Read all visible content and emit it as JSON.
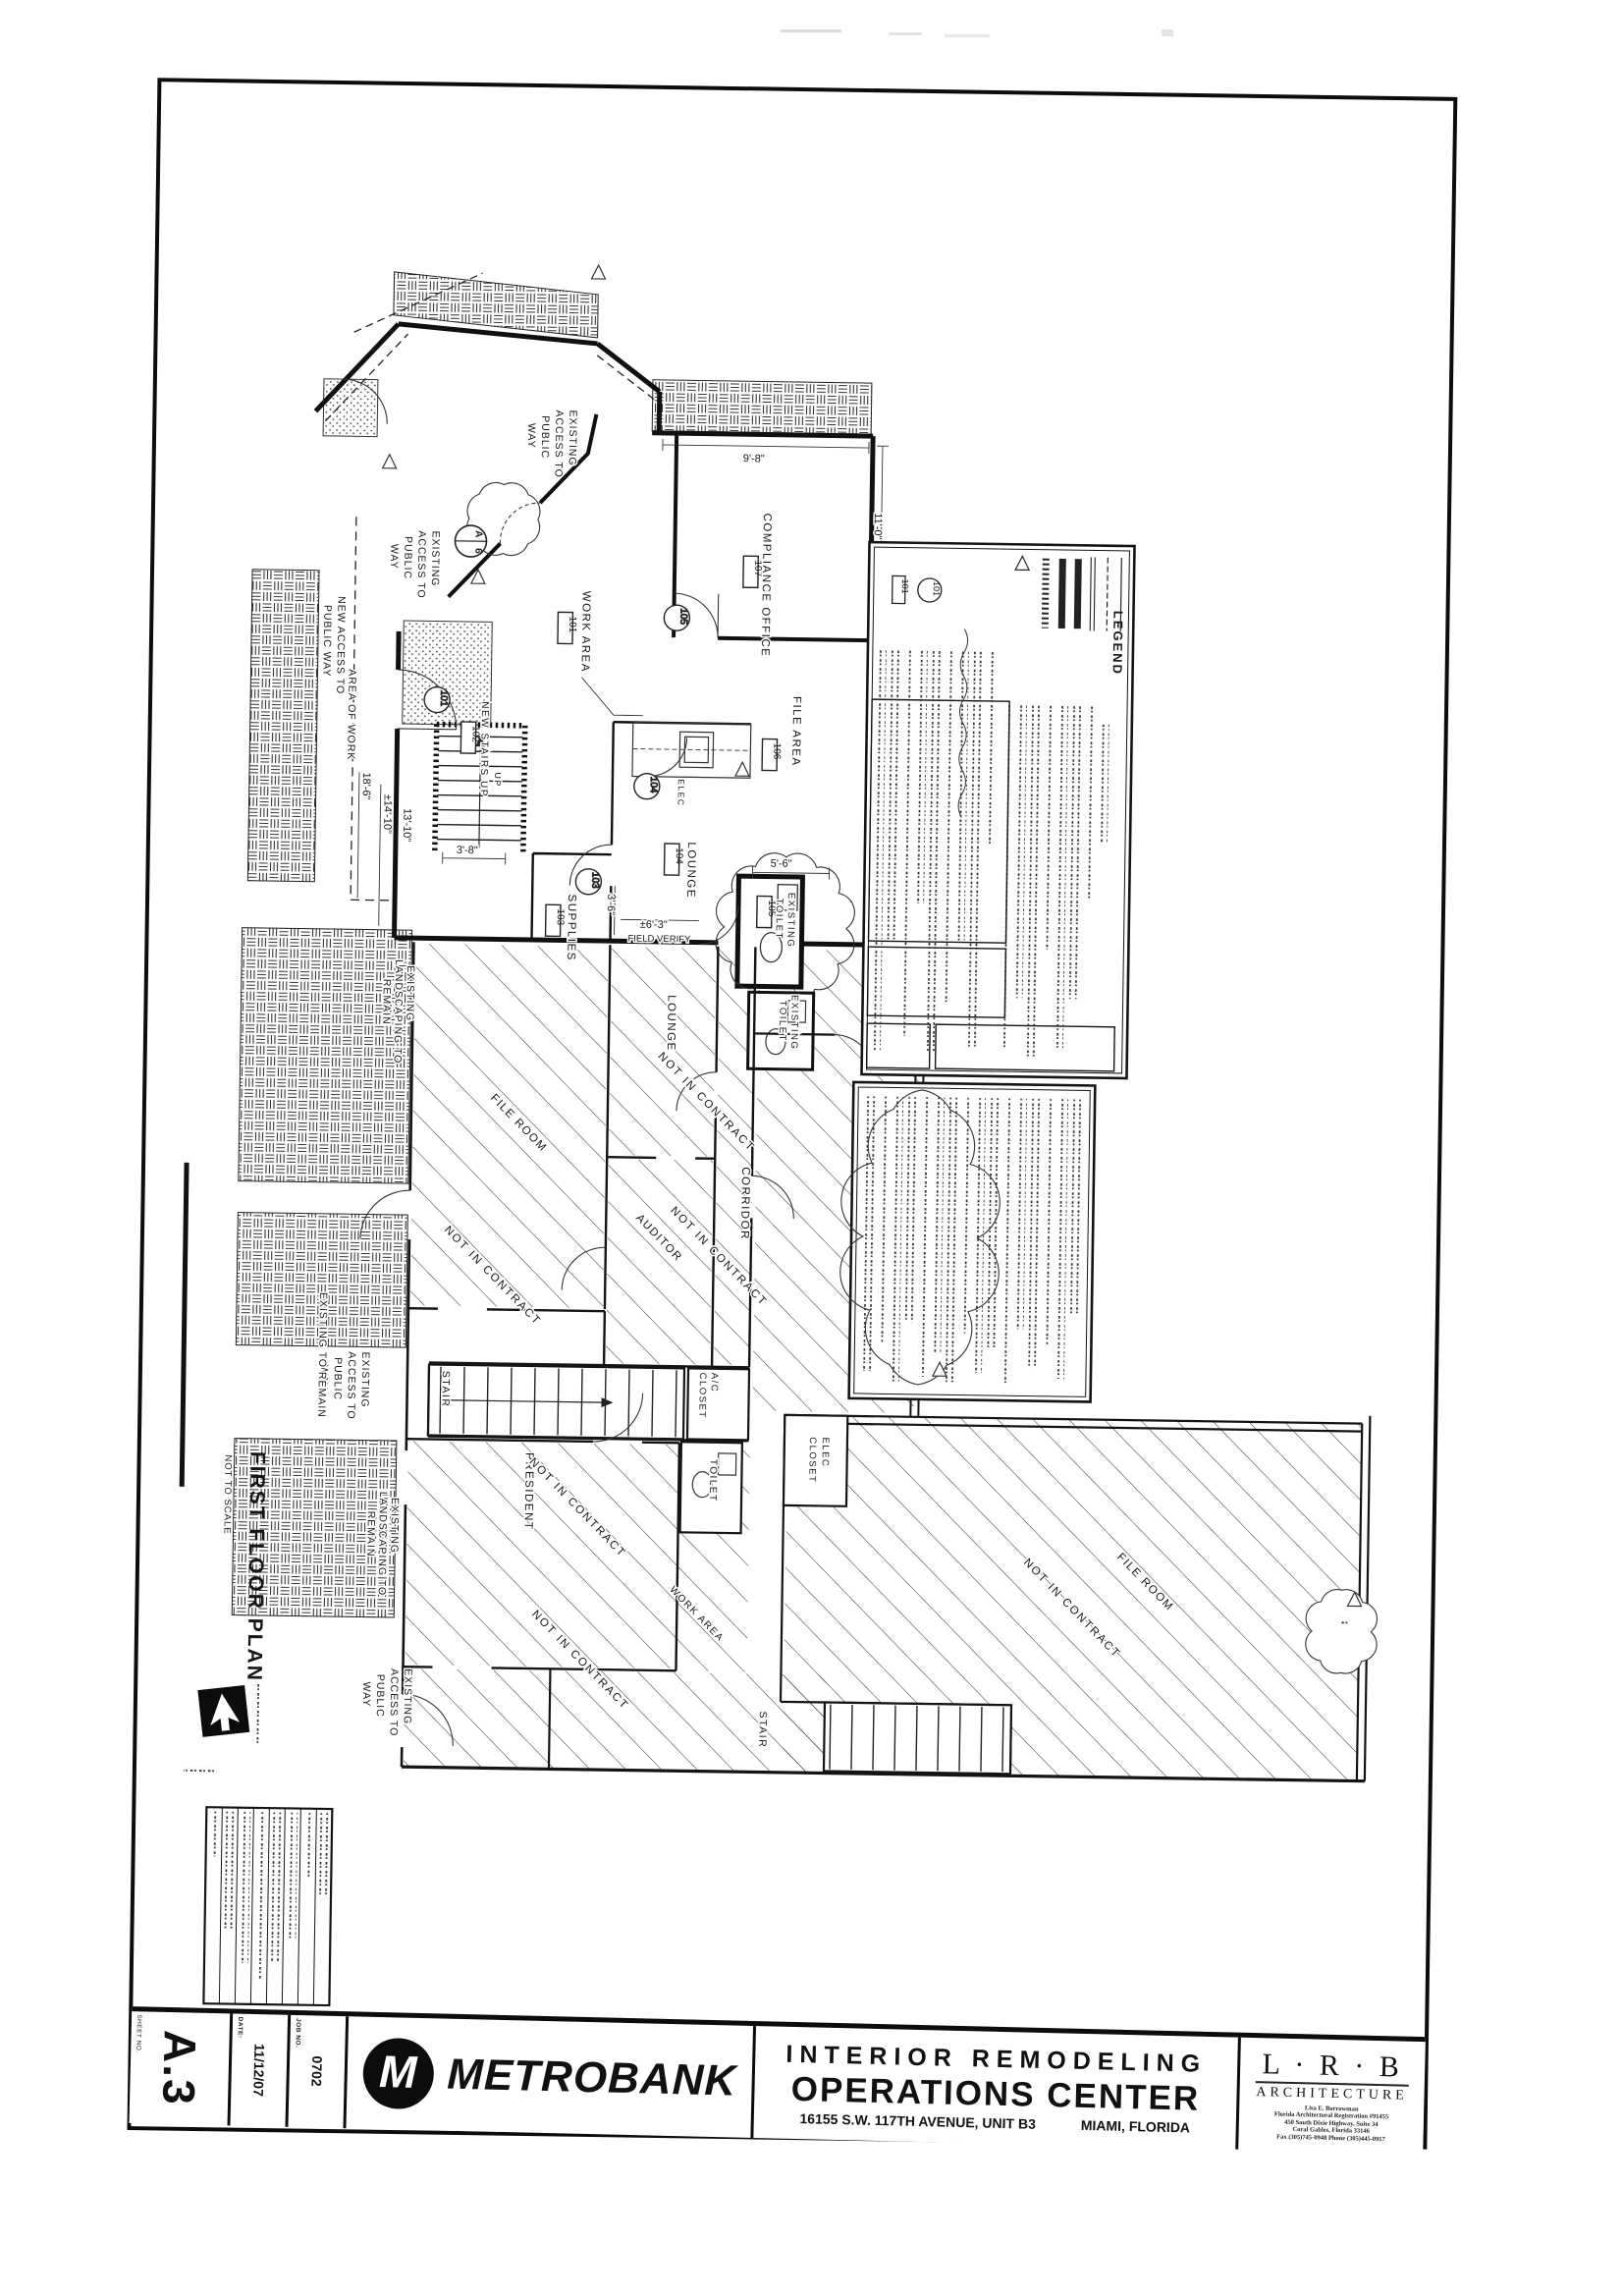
{
  "title_block": {
    "sheet_label": "SHEET NO.",
    "sheet_no": "A.3",
    "date_label": "DATE:",
    "date": "11/12/07",
    "job_label": "JOB NO.",
    "job_no": "0702",
    "logo_monogram": "M",
    "client": "METROBANK",
    "project_line1": "INTERIOR REMODELING",
    "project_line2": "OPERATIONS CENTER",
    "address": "16155 S.W. 117TH AVENUE, UNIT B3",
    "city": "MIAMI, FLORIDA",
    "architect": {
      "initials": "L · R · B",
      "firm": "ARCHITECTURE",
      "lines": [
        "Lisa E. Borrowman",
        "Florida Architectural Registration #91455",
        "450 South Dixie Highway, Suite 34",
        "Coral Gables, Florida 33146",
        "Fax (305)745-0948    Phone (305)445-0917"
      ]
    }
  },
  "plan_title": {
    "title": "FIRST FLOOR PLAN",
    "scale": "NOT TO SCALE"
  },
  "legend": {
    "title": "LEGEND",
    "sample_tag": "101"
  },
  "rooms": {
    "work_area": "WORK AREA",
    "compliance_office": "COMPLIANCE OFFICE",
    "file_area": "FILE AREA",
    "lounge": "LOUNGE",
    "supplies": "SUPPLIES",
    "new_stairs": "NEW STAIRS UP",
    "up": "UP",
    "elec": "ELEC",
    "existing_toilet_1": "EXISTING",
    "existing_toilet_2": "TOILET",
    "lounge_lower": "LOUNGE",
    "file_room": "FILE ROOM",
    "auditor": "AUDITOR",
    "corridor": "CORRIDOR",
    "stair": "STAIR",
    "ac_closet_1": "A/C",
    "ac_closet_2": "CLOSET",
    "toilet": "TOILET",
    "elec_closet_1": "ELEC",
    "elec_closet_2": "CLOSET",
    "president": "PRESIDENT",
    "work_area_lower": "WORK AREA",
    "file_room_lower": "FILE ROOM"
  },
  "annotations": {
    "not_in_contract": "NOT IN CONTRACT",
    "existing_access_1": "EXISTING",
    "existing_access_2": "ACCESS TO",
    "existing_access_3": "PUBLIC",
    "existing_access_4": "WAY",
    "new_access_1": "NEW ACCESS TO",
    "new_access_2": "PUBLIC WAY",
    "area_of_work": "AREA OF WORK",
    "existing_to_remain": "EXISTING TO REMAIN",
    "landscaping_1": "EXISTING",
    "landscaping_2": "LANDSCAPING TO",
    "landscaping_3": "REMAIN",
    "field_verify": "FIELD VERIFY"
  },
  "dims": {
    "d9_8": "9'-8\"",
    "d11_0": "11'-0\"",
    "d18_6": "18'-6\"",
    "d14_10": "±14'-10\"",
    "d13_10": "13'-10\"",
    "d3_8": "3'-8\"",
    "d3_6": "3'-6\"",
    "d6_3": "±6'-3\"",
    "d5_6": "5'-6\""
  },
  "tags": {
    "room_101": "101",
    "room_102": "102",
    "room_103": "103",
    "room_104": "104",
    "room_105": "105",
    "room_106": "106",
    "room_107": "107",
    "door_101": "101",
    "door_103": "103",
    "door_104": "104",
    "door_105": "105",
    "detail_letter": "A",
    "detail_number": "6"
  }
}
